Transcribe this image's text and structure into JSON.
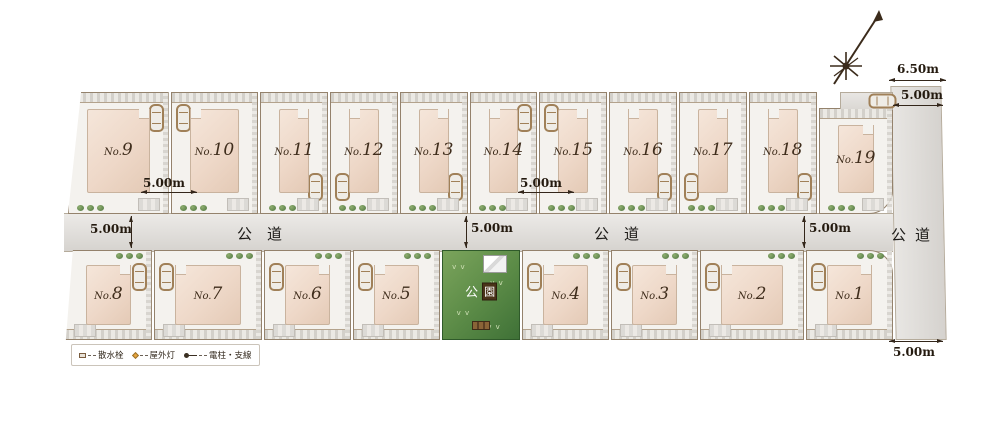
{
  "plan": {
    "lots_top_row": [
      {
        "id": "9",
        "prefix": "No.",
        "number": "9",
        "car": "tr"
      },
      {
        "id": "10",
        "prefix": "No.",
        "number": "10",
        "car": "tl"
      },
      {
        "id": "11",
        "prefix": "No.",
        "number": "11",
        "car": "br"
      },
      {
        "id": "12",
        "prefix": "No.",
        "number": "12",
        "car": "bl"
      },
      {
        "id": "13",
        "prefix": "No.",
        "number": "13",
        "car": "br"
      },
      {
        "id": "14",
        "prefix": "No.",
        "number": "14",
        "car": "tr"
      },
      {
        "id": "15",
        "prefix": "No.",
        "number": "15",
        "car": "tl"
      },
      {
        "id": "16",
        "prefix": "No.",
        "number": "16",
        "car": "br"
      },
      {
        "id": "17",
        "prefix": "No.",
        "number": "17",
        "car": "bl"
      },
      {
        "id": "18",
        "prefix": "No.",
        "number": "18",
        "car": "br"
      },
      {
        "id": "19",
        "prefix": "No.",
        "number": "19",
        "car": "th"
      }
    ],
    "lots_bottom_row": [
      {
        "type": "lot",
        "id": "8",
        "prefix": "No.",
        "number": "8",
        "car": "tr"
      },
      {
        "type": "lot",
        "id": "7",
        "prefix": "No.",
        "number": "7",
        "car": "tl"
      },
      {
        "type": "lot",
        "id": "6",
        "prefix": "No.",
        "number": "6",
        "car": "tl"
      },
      {
        "type": "lot",
        "id": "5",
        "prefix": "No.",
        "number": "5",
        "car": "tl"
      },
      {
        "type": "park"
      },
      {
        "type": "lot",
        "id": "4",
        "prefix": "No.",
        "number": "4",
        "car": "tl"
      },
      {
        "type": "lot",
        "id": "3",
        "prefix": "No.",
        "number": "3",
        "car": "tl"
      },
      {
        "type": "lot",
        "id": "2",
        "prefix": "No.",
        "number": "2",
        "car": "tl"
      },
      {
        "type": "lot",
        "id": "1",
        "prefix": "No.",
        "number": "1",
        "car": "tl"
      }
    ],
    "park": {
      "first": "公",
      "second": "園"
    },
    "roads": {
      "middle_west": "公道",
      "middle_east": "公道",
      "right": "公道"
    },
    "dimensions": {
      "top_width": "6.50m",
      "top_parking": "5.00m",
      "road_left": "5.00m",
      "driveway_west": "5.00m",
      "road_center": "5.00m",
      "driveway_east": "5.00m",
      "road_east": "5.00m",
      "bottom_right": "5.00m"
    },
    "legend": {
      "items": [
        {
          "symbol": "sprinkler-icon",
          "label": "散水栓"
        },
        {
          "symbol": "outdoor-light-icon",
          "label": "屋外灯"
        },
        {
          "symbol": "utility-pole-icon",
          "label": "電柱・支線"
        }
      ]
    }
  }
}
